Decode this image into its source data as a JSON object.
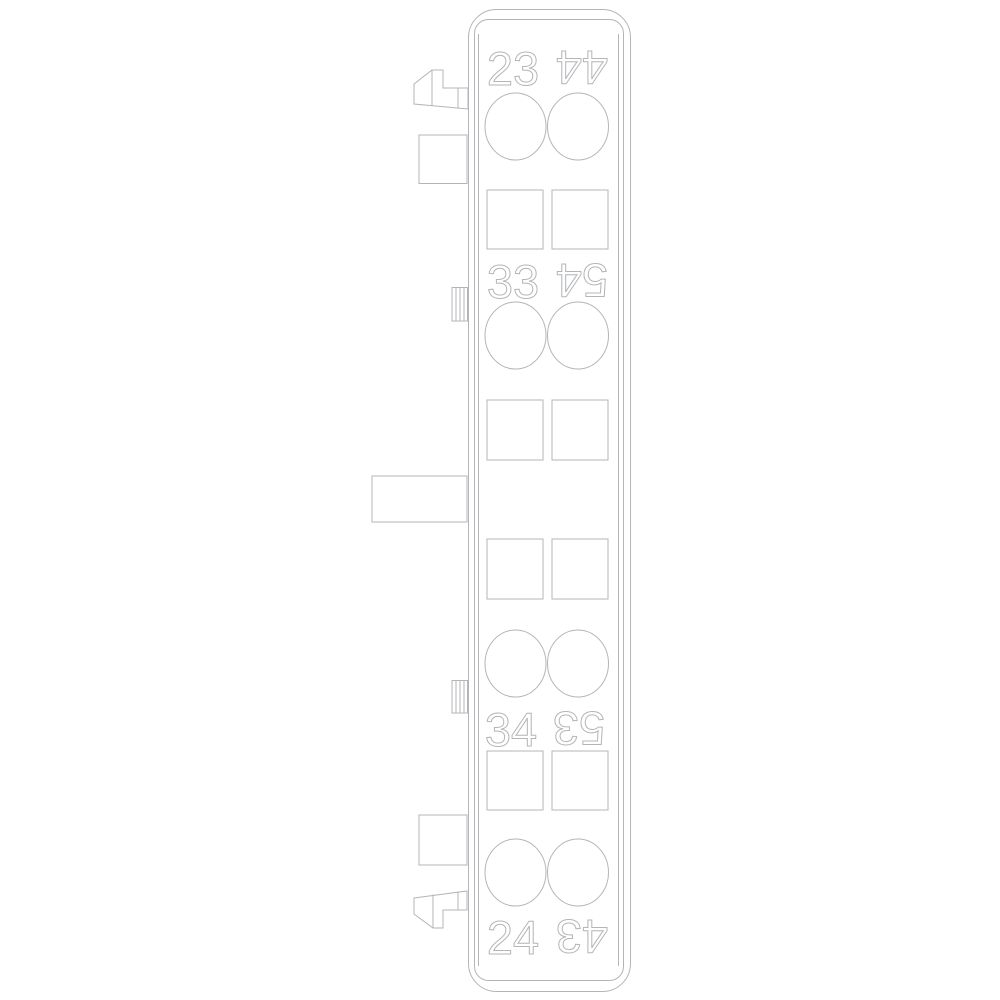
{
  "drawing": {
    "title": "Auxiliary contact block - side profile technical line drawing",
    "colors": {
      "line": "#b3b5b8",
      "background": "#ffffff"
    },
    "rows": [
      {
        "left": "23",
        "right": "44",
        "right_rotated_180": true
      },
      {
        "left": "33",
        "right": "54",
        "right_rotated_180": true
      },
      {
        "left": "34",
        "right": "53",
        "right_rotated_180": true
      },
      {
        "left": "24",
        "right": "43",
        "right_rotated_180": true
      }
    ]
  }
}
